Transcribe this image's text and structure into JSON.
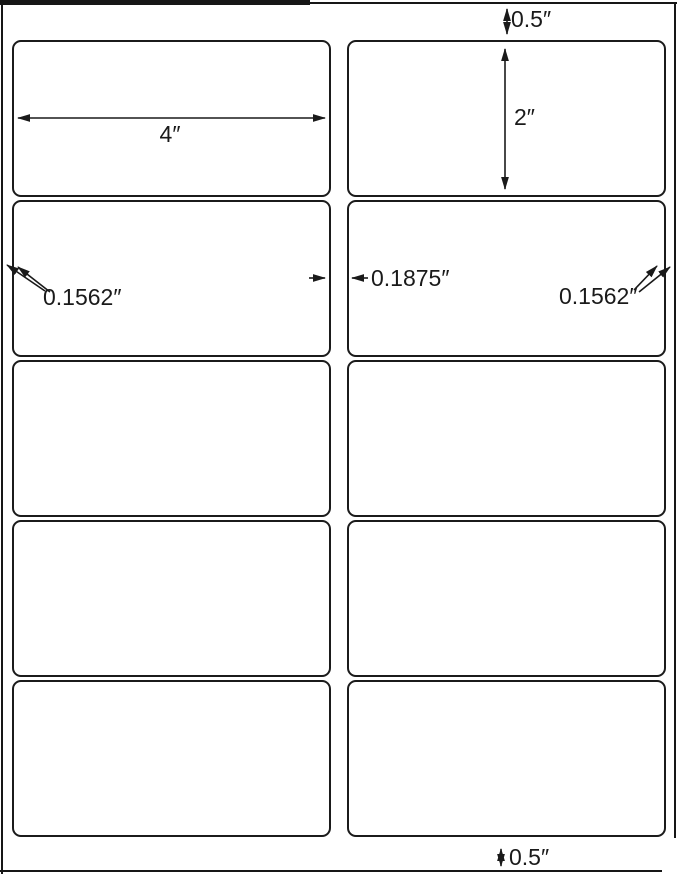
{
  "diagram": {
    "sheet": {
      "rows": 5,
      "columns": 2,
      "label_count": 10
    },
    "colors": {
      "ink": "#1a1a1a",
      "paper": "#ffffff"
    }
  },
  "dimensions": {
    "top_margin": "0.5″",
    "label_width": "4″",
    "label_height": "2″",
    "left_margin": "0.1562″",
    "column_gap": "0.1875″",
    "right_margin": "0.1562″",
    "bottom_margin": "0.5″"
  }
}
